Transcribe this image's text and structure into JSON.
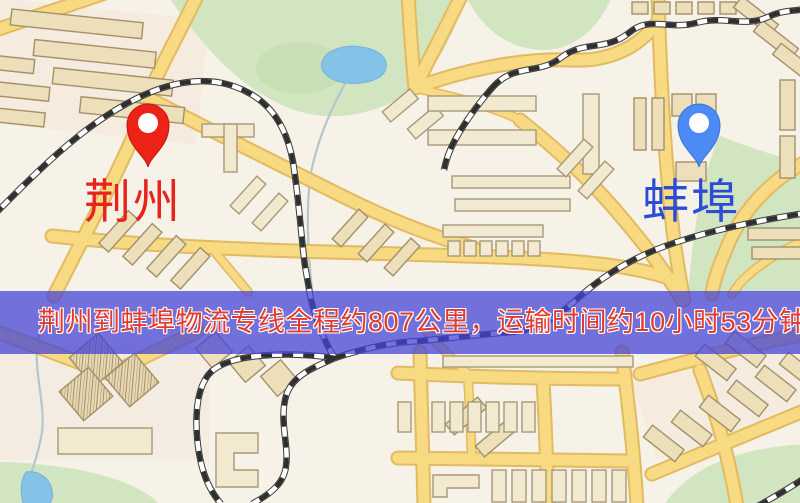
{
  "banner": {
    "text": "荆州到蚌埠物流专线全程约807公里，运输时间约10小时53分钟.",
    "background": "rgba(68,66,214,0.74)",
    "text_color": "#e23b2e",
    "outline_color": "#ffffff"
  },
  "markers": {
    "jingzhou": {
      "label": "荆州",
      "pin_color": "#ee2318",
      "pin_stroke": "#c6170f",
      "label_color": "#e6241c"
    },
    "bengbu": {
      "label": "蚌埠",
      "pin_color": "#4c8bf5",
      "pin_stroke": "#3c73d6",
      "label_color": "#2b4cd6"
    }
  },
  "palette": {
    "map_base": "#f7f2e8",
    "road_fill": "#f7da82",
    "road_casing": "#e2ba62",
    "park_green": "#d2e5c1",
    "water_blue": "#85c2e8",
    "building_fill": "#ecdfba",
    "building_stroke": "#a2906c",
    "railway_dark": "#2f2f2f"
  }
}
